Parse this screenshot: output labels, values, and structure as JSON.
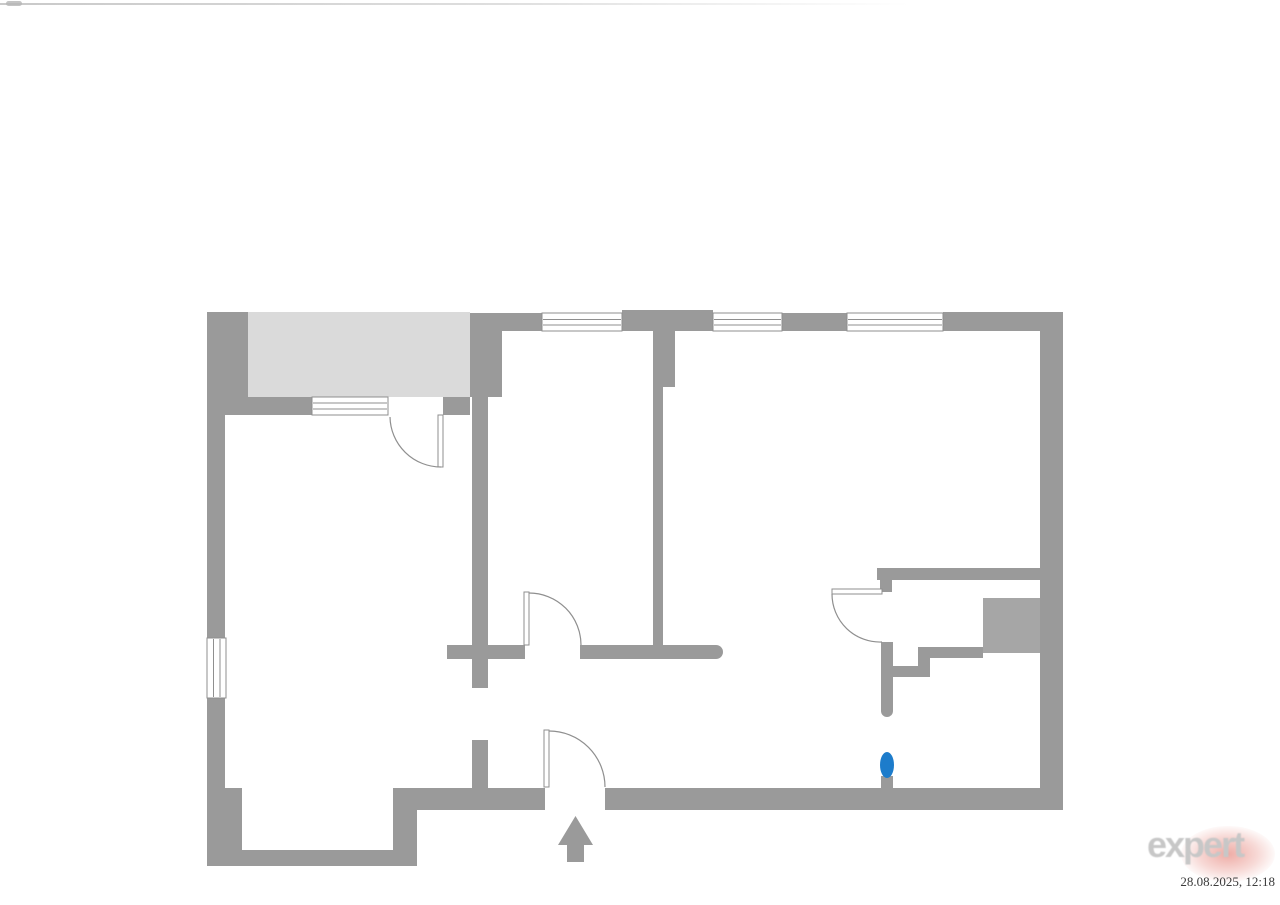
{
  "page": {
    "background": "#ffffff"
  },
  "brand": {
    "logo_text": "expert",
    "timestamp": "28.08.2025, 12:18"
  },
  "colors": {
    "wall_gray": "#9a9a9a",
    "balcony_fill": "#dadada",
    "shaft_fill": "#a6a6a6",
    "marker_blue": "#1d7ccb",
    "thin_line_gray": "#8f8f8f",
    "logo_text_gray": "#c7c7c7",
    "logo_blob_red": "#e0685c",
    "timestamp_text": "#3c3c3c"
  }
}
